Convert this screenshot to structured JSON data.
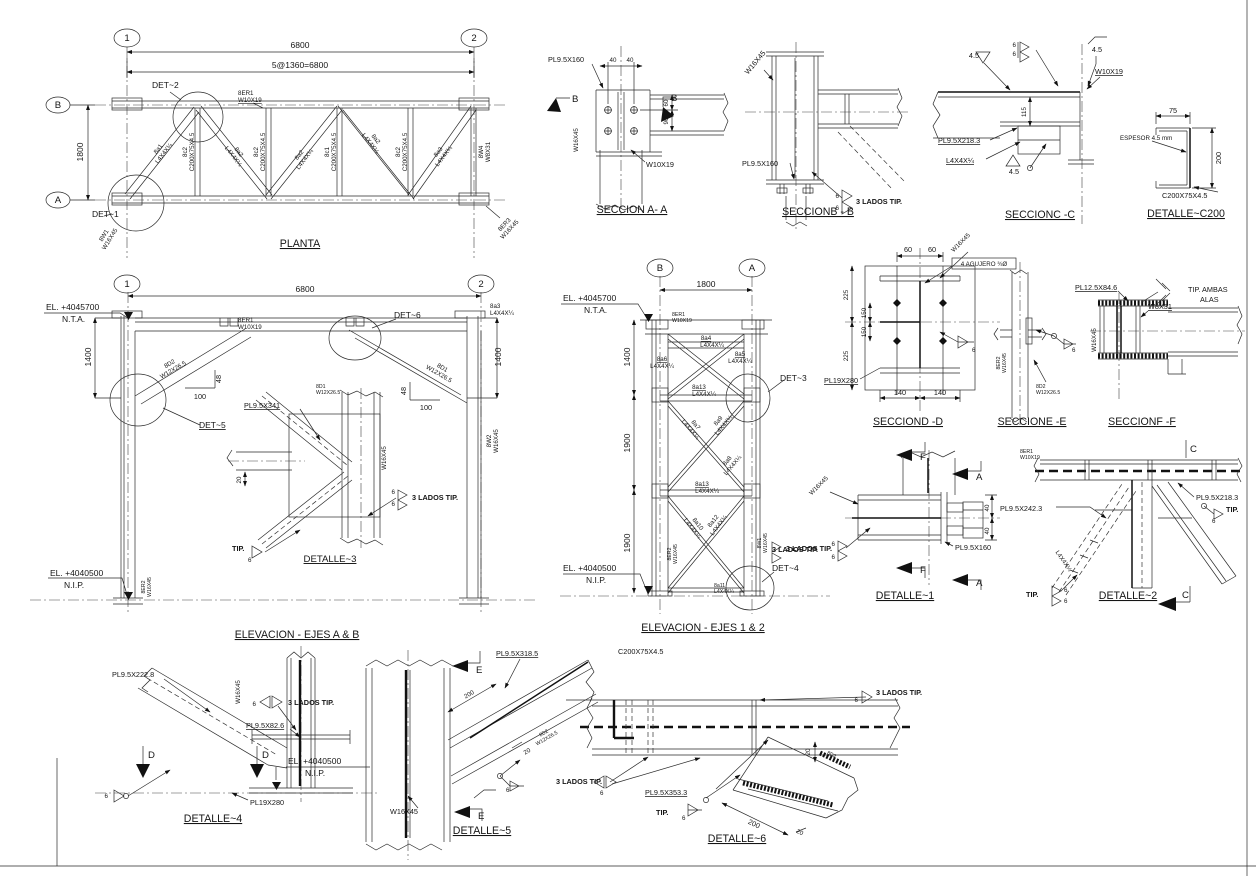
{
  "common": {
    "weld_6": "6",
    "weld_45": "4.5",
    "tip": "TIP.",
    "tres_lados_tip": "3 LADOS TIP.",
    "angle": "L4X4X¼",
    "w16x45": "W16X45",
    "w10x19": "W10X19",
    "w12x265": "W12X26.5",
    "w8x31": "W8X31",
    "c200": "C200X75X4.5",
    "pl95x160": "PL9.5X160",
    "pl19x280": "PL19X280",
    "pl95x2183": "PL9.5X218.3",
    "pl95x2423": "PL9.5X242.3",
    "mark_8er1": "8ER1",
    "mark_8er2": "8ER2",
    "mark_8d1": "8D1",
    "mark_8d2": "8D2",
    "mark_8w1": "8W1",
    "mark_8w2": "8W2",
    "el_top": "EL. +4045700",
    "el_bot": "EL. +4040500",
    "nta": "N.T.A.",
    "nip": "N.I.P.",
    "dim_20": "20",
    "dim_40": "40",
    "dim_48": "48",
    "dim_60": "60",
    "dim_75": "75",
    "dim_90": "90",
    "dim_100": "100",
    "dim_115": "115",
    "dim_140": "140",
    "dim_150": "150",
    "dim_200": "200",
    "dim_225": "225",
    "dim_1400": "1400",
    "dim_1800": "1800",
    "dim_1900": "1900",
    "dim_6800": "6800"
  },
  "views": {
    "planta": {
      "title": "PLANTA",
      "grid_1": "1",
      "grid_2": "2",
      "grid_a": "A",
      "grid_b": "B",
      "dim_panels": "5@1360=6800",
      "det1": "DET~1",
      "det2": "DET~2",
      "mark_a1": "8a1",
      "mark_a2": "8a2",
      "mark_a3": "8a3",
      "mark_c1": "8c1",
      "mark_c2": "8c2",
      "mark_w4": "8W4",
      "mark_er3": "8ER3"
    },
    "seccion_aa": {
      "title": "SECCION A- A",
      "sec": "B"
    },
    "seccion_bb": {
      "title": "SECCIONB - B"
    },
    "seccion_cc": {
      "title": "SECCIONC -C"
    },
    "detalle_c200": {
      "title": "DETALLE~C200",
      "espesor": "ESPESOR 4.5 mm"
    },
    "elevacion_ab": {
      "title": "ELEVACION - EJES A & B",
      "det3_title": "DETALLE~3",
      "det5": "DET~5",
      "det6": "DET~6",
      "pl341": "PL9.5X341",
      "mark_a3": "8a3"
    },
    "elevacion_12": {
      "title": "ELEVACION - EJES 1 & 2",
      "det3": "DET~3",
      "det4": "DET~4",
      "marks": {
        "a4": "8a4",
        "a5": "8a5",
        "a6": "8a6",
        "a7": "8a7",
        "a8": "8a8",
        "a9": "8a9",
        "a10": "8a10",
        "a11": "8a11",
        "a12": "8a12",
        "a13": "8a13"
      }
    },
    "seccion_dd": {
      "title": "SECCIOND -D",
      "agujero": "4 AGUJERO ¾Ø"
    },
    "seccion_ee": {
      "title": "SECCIONE -E"
    },
    "seccion_ff": {
      "title": "SECCIONF -F",
      "pl125": "PL12.5X84.6",
      "tip_ambas_1": "TIP. AMBAS",
      "tip_ambas_2": "ALAS"
    },
    "detalle_1": {
      "title": "DETALLE~1",
      "sec_f": "F",
      "sec_a": "A"
    },
    "detalle_2": {
      "title": "DETALLE~2",
      "sec_c": "C"
    },
    "detalle_4": {
      "title": "DETALLE~4",
      "pl2228": "PL9.5X222.8",
      "pl826": "PL9.5X82.6",
      "sec_d": "D"
    },
    "detalle_5": {
      "title": "DETALLE~5",
      "pl3185": "PL9.5X318.5",
      "sec_e": "E"
    },
    "detalle_6": {
      "title": "DETALLE~6",
      "pl3533": "PL9.5X353.3",
      "d2": "8D2"
    }
  }
}
